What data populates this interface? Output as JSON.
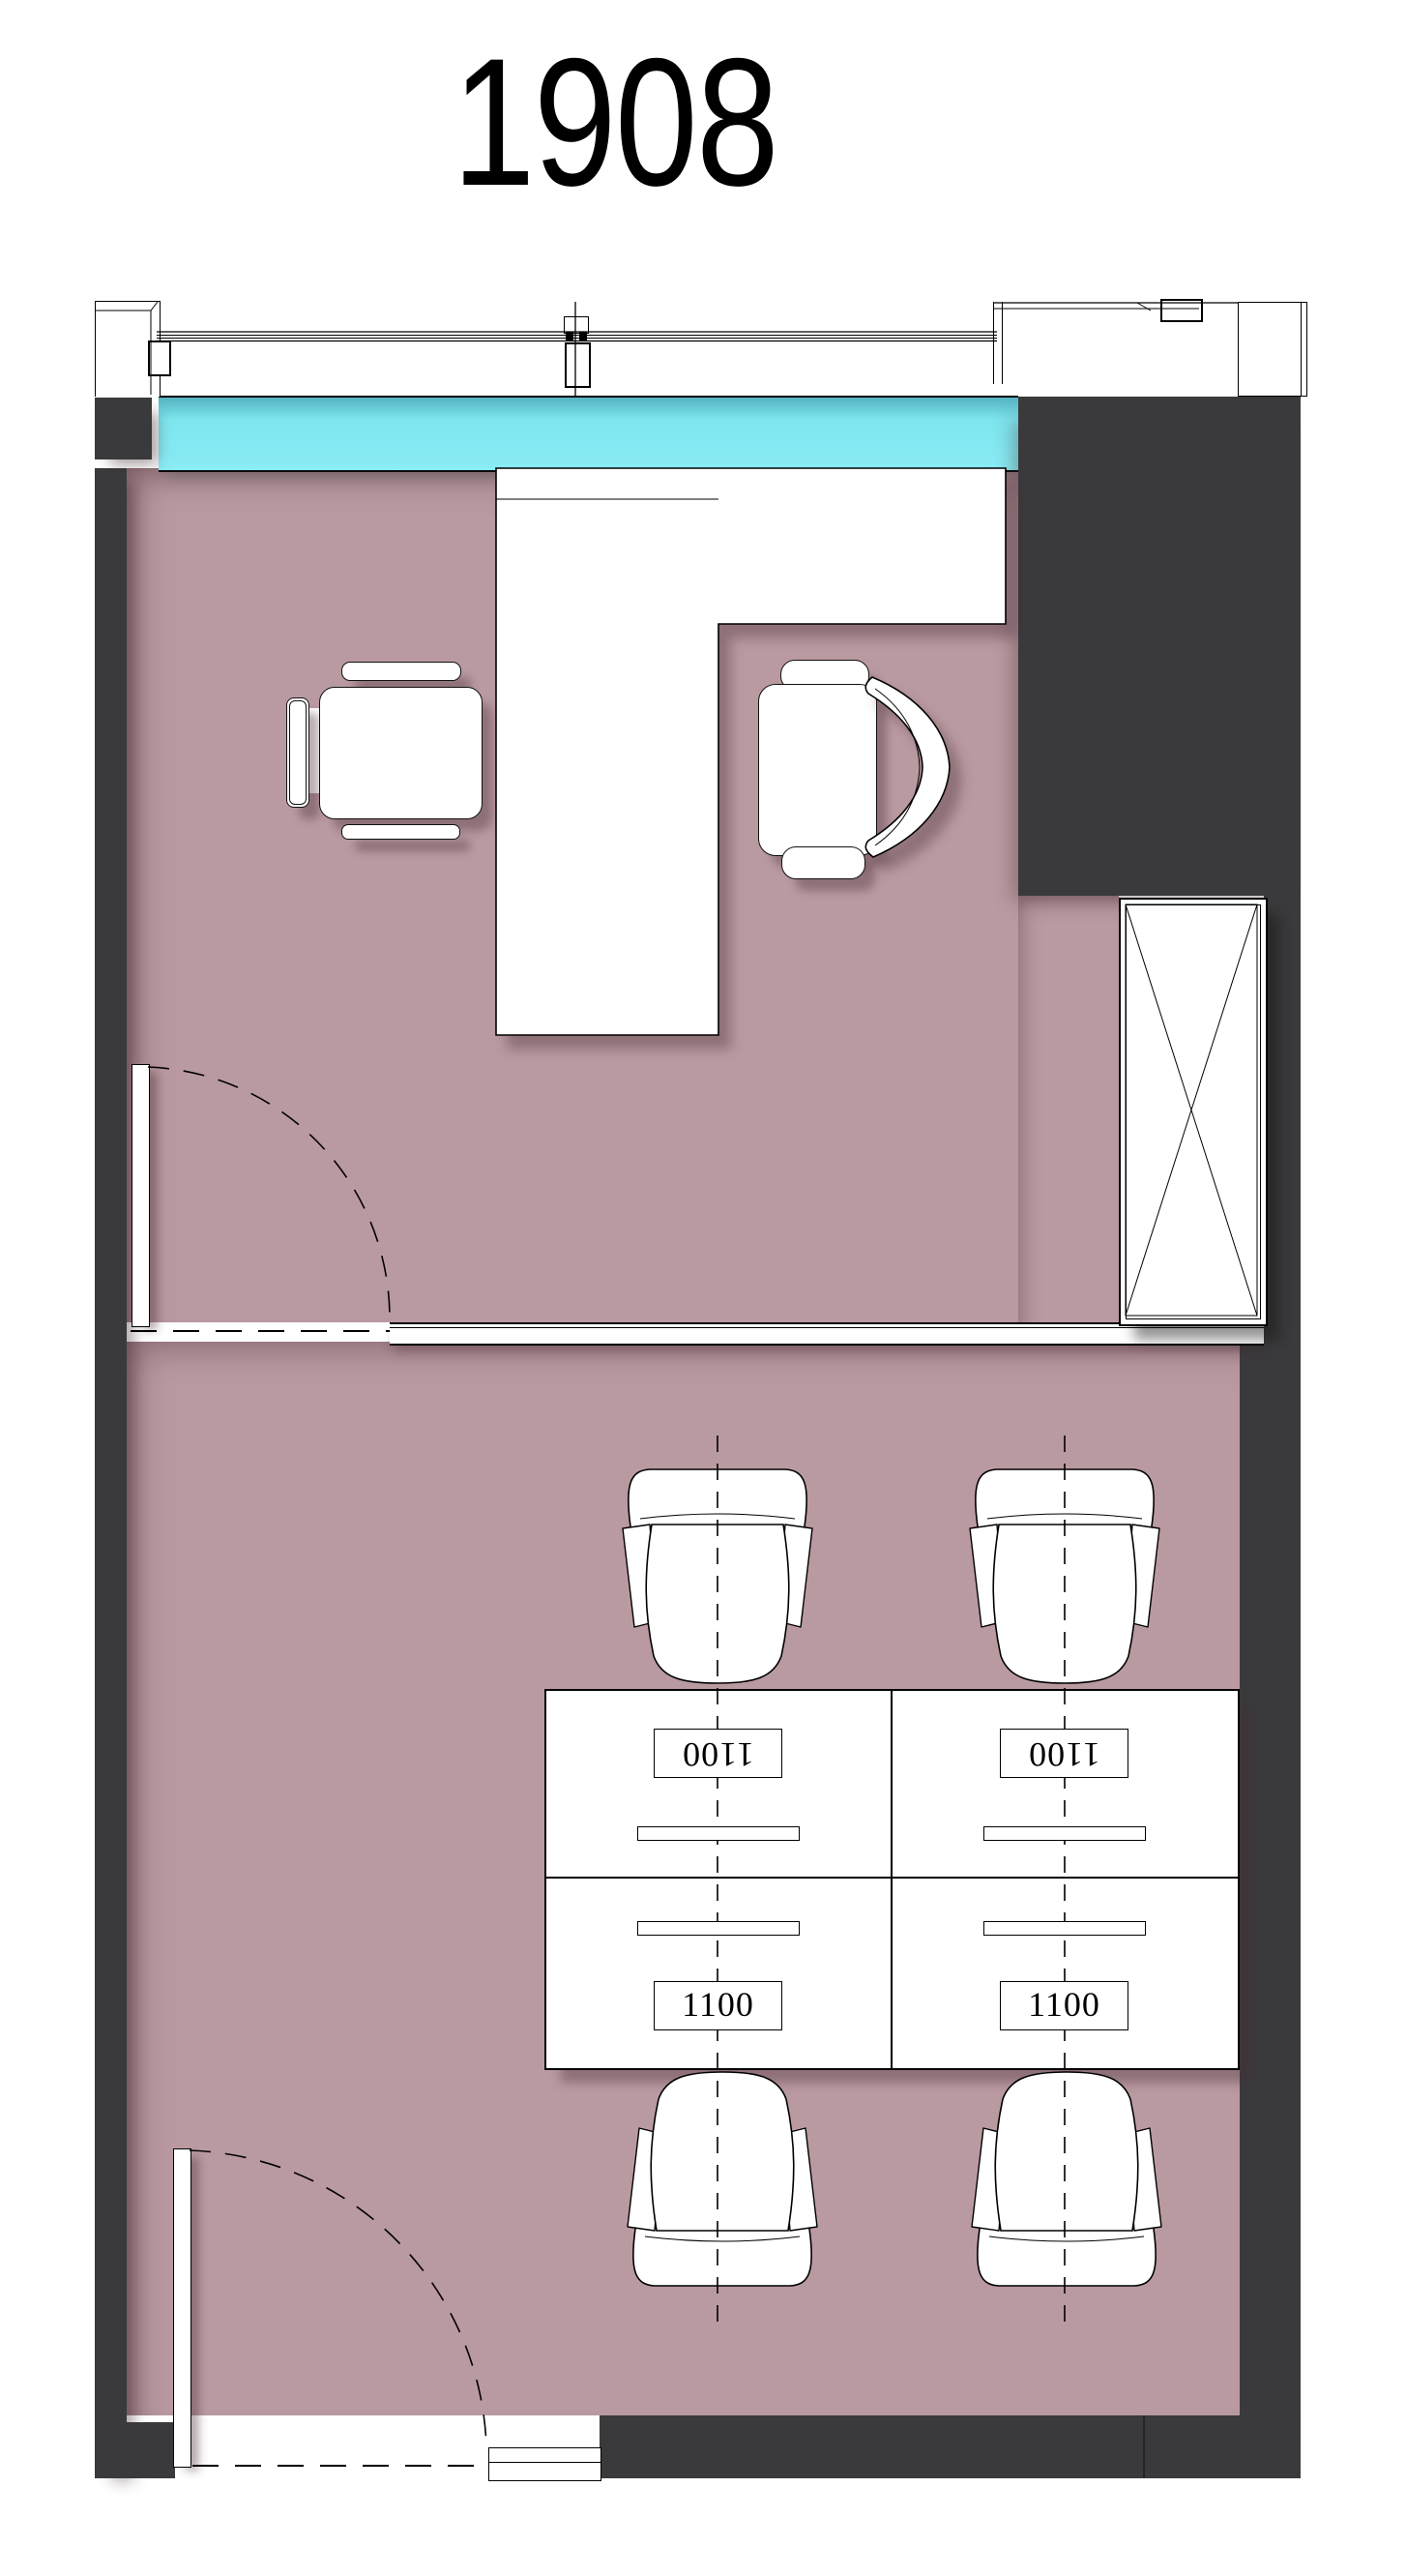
{
  "title": "1908",
  "workstations": {
    "labels": [
      "1100",
      "1100",
      "1100",
      "1100"
    ]
  },
  "colors": {
    "floor": "#ba9aa1",
    "glass": "#85e9f2",
    "wall": "#3a3a3c",
    "line": "#000000",
    "paper": "#ffffff"
  }
}
